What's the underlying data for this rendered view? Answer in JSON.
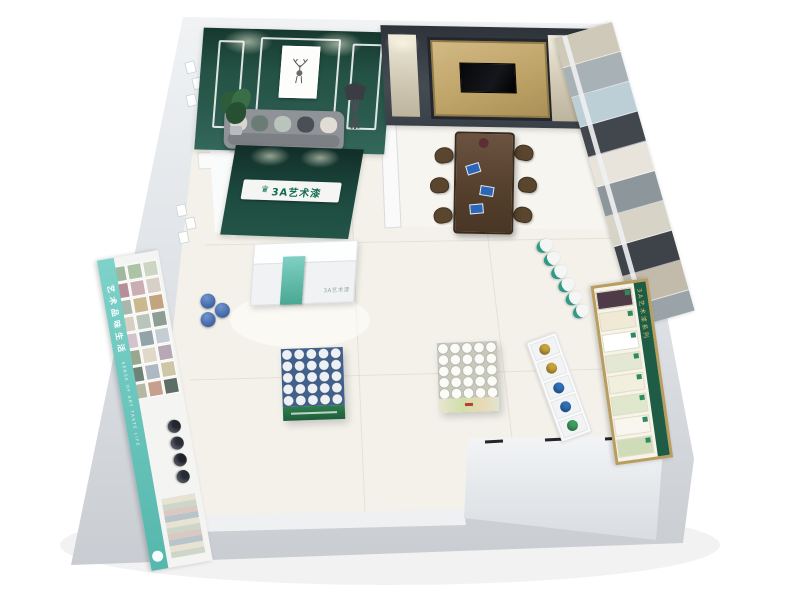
{
  "scene": {
    "type": "3d floor plan render",
    "subject": "paint brand showroom interior viewed from above",
    "background": "#ffffff"
  },
  "brand": {
    "name": "3A艺术漆",
    "logo_icon": "crown-icon",
    "green": "#1d4a40",
    "teal": "#5bbfb2"
  },
  "reception": {
    "sign_text": "3A艺术漆",
    "counter_label": "3A艺术漆",
    "backdrop_color": "#1d4a40",
    "counter_color": "#f0f2f3",
    "stripe_color": "#49a893"
  },
  "lounge": {
    "wall_color": "#2b5b4e",
    "trim_color": "#ffffff",
    "artwork": "deer line-art framed print",
    "sofa_color": "#8f9296",
    "pillow_colors": [
      "#d9d5cf",
      "#6b7c74",
      "#b9c4bd",
      "#4a4f55",
      "#e2ddd4"
    ],
    "plant": "potted plant",
    "lamp": "black floor lamp"
  },
  "meeting": {
    "wall_frame_color": "#3d434b",
    "gold_panel_color": "#c2a870",
    "side_panel_color": "#d8d1c0",
    "tv_color": "#0b0b0d",
    "table_color": "#5a4632",
    "chair_count": 6,
    "brochure_color": "#2b66b8"
  },
  "west_display": {
    "banner_cn": "艺术品味生活",
    "banner_en": "SENSE OF ART TASTE LIFE",
    "banner_color": "#63c3ba",
    "swatches": [
      "#cdd6c4",
      "#adc3a6",
      "#9fb99f",
      "#d8cfc8",
      "#c9aeb4",
      "#b78f9a",
      "#c2a57e",
      "#cbb891",
      "#a9b5ad",
      "#8e9e94",
      "#b9c4bb",
      "#d6d0c0",
      "#c4cdd4",
      "#93a4a8",
      "#d2c3cd",
      "#b8a7b4",
      "#e0d8c8",
      "#9aa78f",
      "#cfc6a8",
      "#adb8c2",
      "#6f8277",
      "#5d6e66",
      "#c79f8f",
      "#b5b9a4"
    ],
    "dark_cans": [
      "#23262f",
      "#2a2d38",
      "#1f222b",
      "#262a34"
    ],
    "blue_can_color": "#2d4f8f"
  },
  "east_display": {
    "panel_colors": [
      "#cfc9b9",
      "#a8b1b6",
      "#bccfd6",
      "#42474d",
      "#e8e4db",
      "#8d969b",
      "#d8d3c7",
      "#3e434a",
      "#c2bbab",
      "#9aa3a8"
    ],
    "shelf_buckets": [
      "#f4f6f6",
      "#f4f6f6",
      "#f4f6f6",
      "#f4f6f6",
      "#f4f6f6",
      "#f4f6f6"
    ],
    "bucket_band_color": "#2f9a86",
    "board_header": "3A艺术漆系列",
    "board_frame_color": "#b99d5f",
    "board_header_color": "#1e5c46",
    "board_samples": [
      "#4e3b47",
      "#efe9d6",
      "#ffffff",
      "#e3e8d4",
      "#f3efdf",
      "#dfe7cc",
      "#f8f6ee",
      "#cfdcb8"
    ],
    "cubby_items": [
      "#c8a23c",
      "#c8a23c",
      "#2f6fb5",
      "#2f6fb5",
      "#3f9e5f"
    ]
  },
  "stands": {
    "stand_a": {
      "rows": 5,
      "cols": 5,
      "lid_color": "#eef1f4",
      "gap_color": "#41618e",
      "base_color": "#2e7d4f"
    },
    "stand_b": {
      "rows": 5,
      "cols": 5,
      "lid_color": "#fbfbf8",
      "gap_color": "#c9c9bc",
      "base_color": "#cfe0a8"
    }
  },
  "entrance": {
    "wall_color": "#e9ecee",
    "door_mark_count": 3
  }
}
